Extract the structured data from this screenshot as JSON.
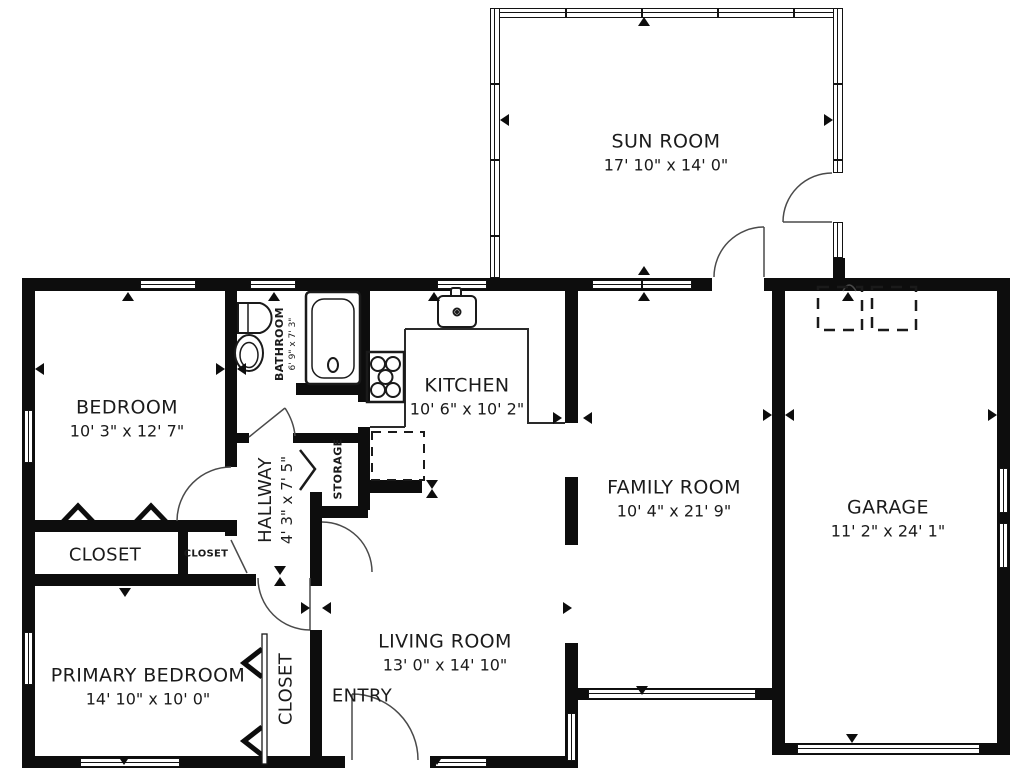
{
  "plan_title": "Residential floor plan",
  "rooms": {
    "sun_room": {
      "name": "SUN ROOM",
      "dims": "17' 10\" x 14' 0\""
    },
    "bedroom": {
      "name": "BEDROOM",
      "dims": "10' 3\" x 12' 7\""
    },
    "bathroom": {
      "name": "BATHROOM",
      "dims": "6' 9\" x 7' 3\""
    },
    "kitchen": {
      "name": "KITCHEN",
      "dims": "10' 6\" x 10' 2\""
    },
    "family_room": {
      "name": "FAMILY ROOM",
      "dims": "10' 4\" x 21' 9\""
    },
    "garage": {
      "name": "GARAGE",
      "dims": "11' 2\" x 24' 1\""
    },
    "hallway": {
      "name": "HALLWAY",
      "dims": "4' 3\" x 7' 5\""
    },
    "living_room": {
      "name": "LIVING ROOM",
      "dims": "13' 0\" x 14' 10\""
    },
    "primary_bedroom": {
      "name": "PRIMARY BEDROOM",
      "dims": "14' 10\" x 10' 0\""
    },
    "storage": {
      "name": "STORAGE"
    },
    "entry": {
      "name": "ENTRY"
    },
    "closet_bedroom": {
      "name": "CLOSET"
    },
    "closet_hall": {
      "name": "CLOSET"
    },
    "closet_primary": {
      "name": "CLOSET"
    }
  },
  "colors": {
    "wall": "#0d0d0d",
    "background": "#ffffff",
    "text": "#1b1b1b",
    "door_line": "#4a4a4a"
  }
}
